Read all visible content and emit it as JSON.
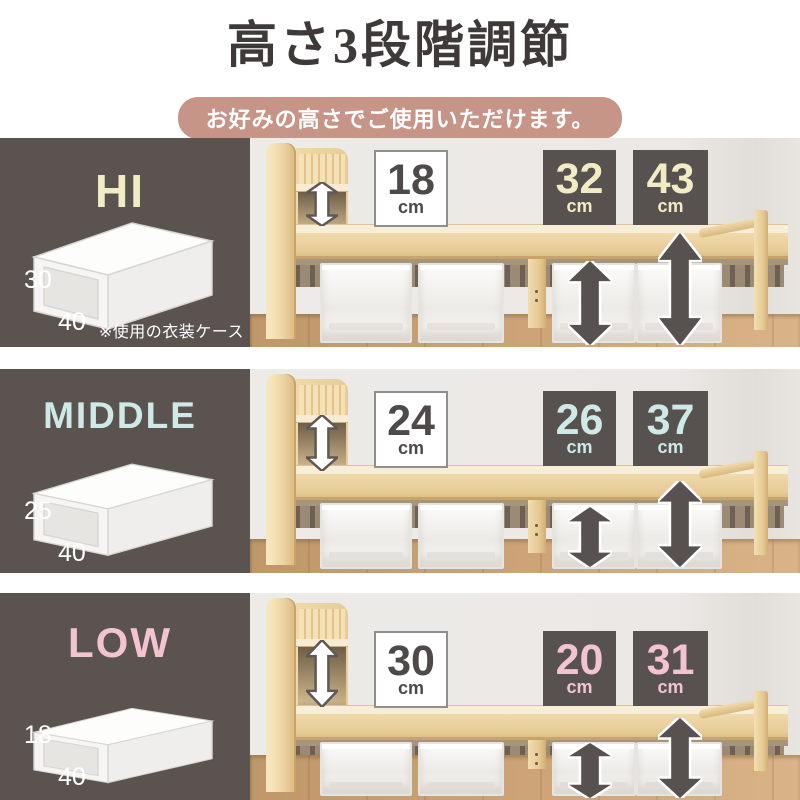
{
  "header": {
    "title": "高さ3段階調節",
    "subtitle": "お好みの高さでご使用いただけます。"
  },
  "colors": {
    "title_color": "#3e3a39",
    "badge_bg": "#c79488",
    "panel_bg": "#5a5350",
    "dark_box_bg": "#57514f",
    "number_dark": "#4d4a49"
  },
  "rows": [
    {
      "id": "hi",
      "label": "HI",
      "accent": "#f2ecc5",
      "case_height": "30",
      "case_depth": "40",
      "note": "※使用の衣装ケース",
      "gap": {
        "value": "18",
        "unit": "cm"
      },
      "under_side": {
        "value": "32",
        "unit": "cm"
      },
      "under_end": {
        "value": "43",
        "unit": "cm"
      }
    },
    {
      "id": "middle",
      "label": "MIDDLE",
      "accent": "#cfe9e6",
      "case_height": "25",
      "case_depth": "40",
      "gap": {
        "value": "24",
        "unit": "cm"
      },
      "under_side": {
        "value": "26",
        "unit": "cm"
      },
      "under_end": {
        "value": "37",
        "unit": "cm"
      }
    },
    {
      "id": "low",
      "label": "LOW",
      "accent": "#f3c3d2",
      "case_height": "18",
      "case_depth": "40",
      "gap": {
        "value": "30",
        "unit": "cm"
      },
      "under_side": {
        "value": "20",
        "unit": "cm"
      },
      "under_end": {
        "value": "31",
        "unit": "cm"
      }
    }
  ]
}
